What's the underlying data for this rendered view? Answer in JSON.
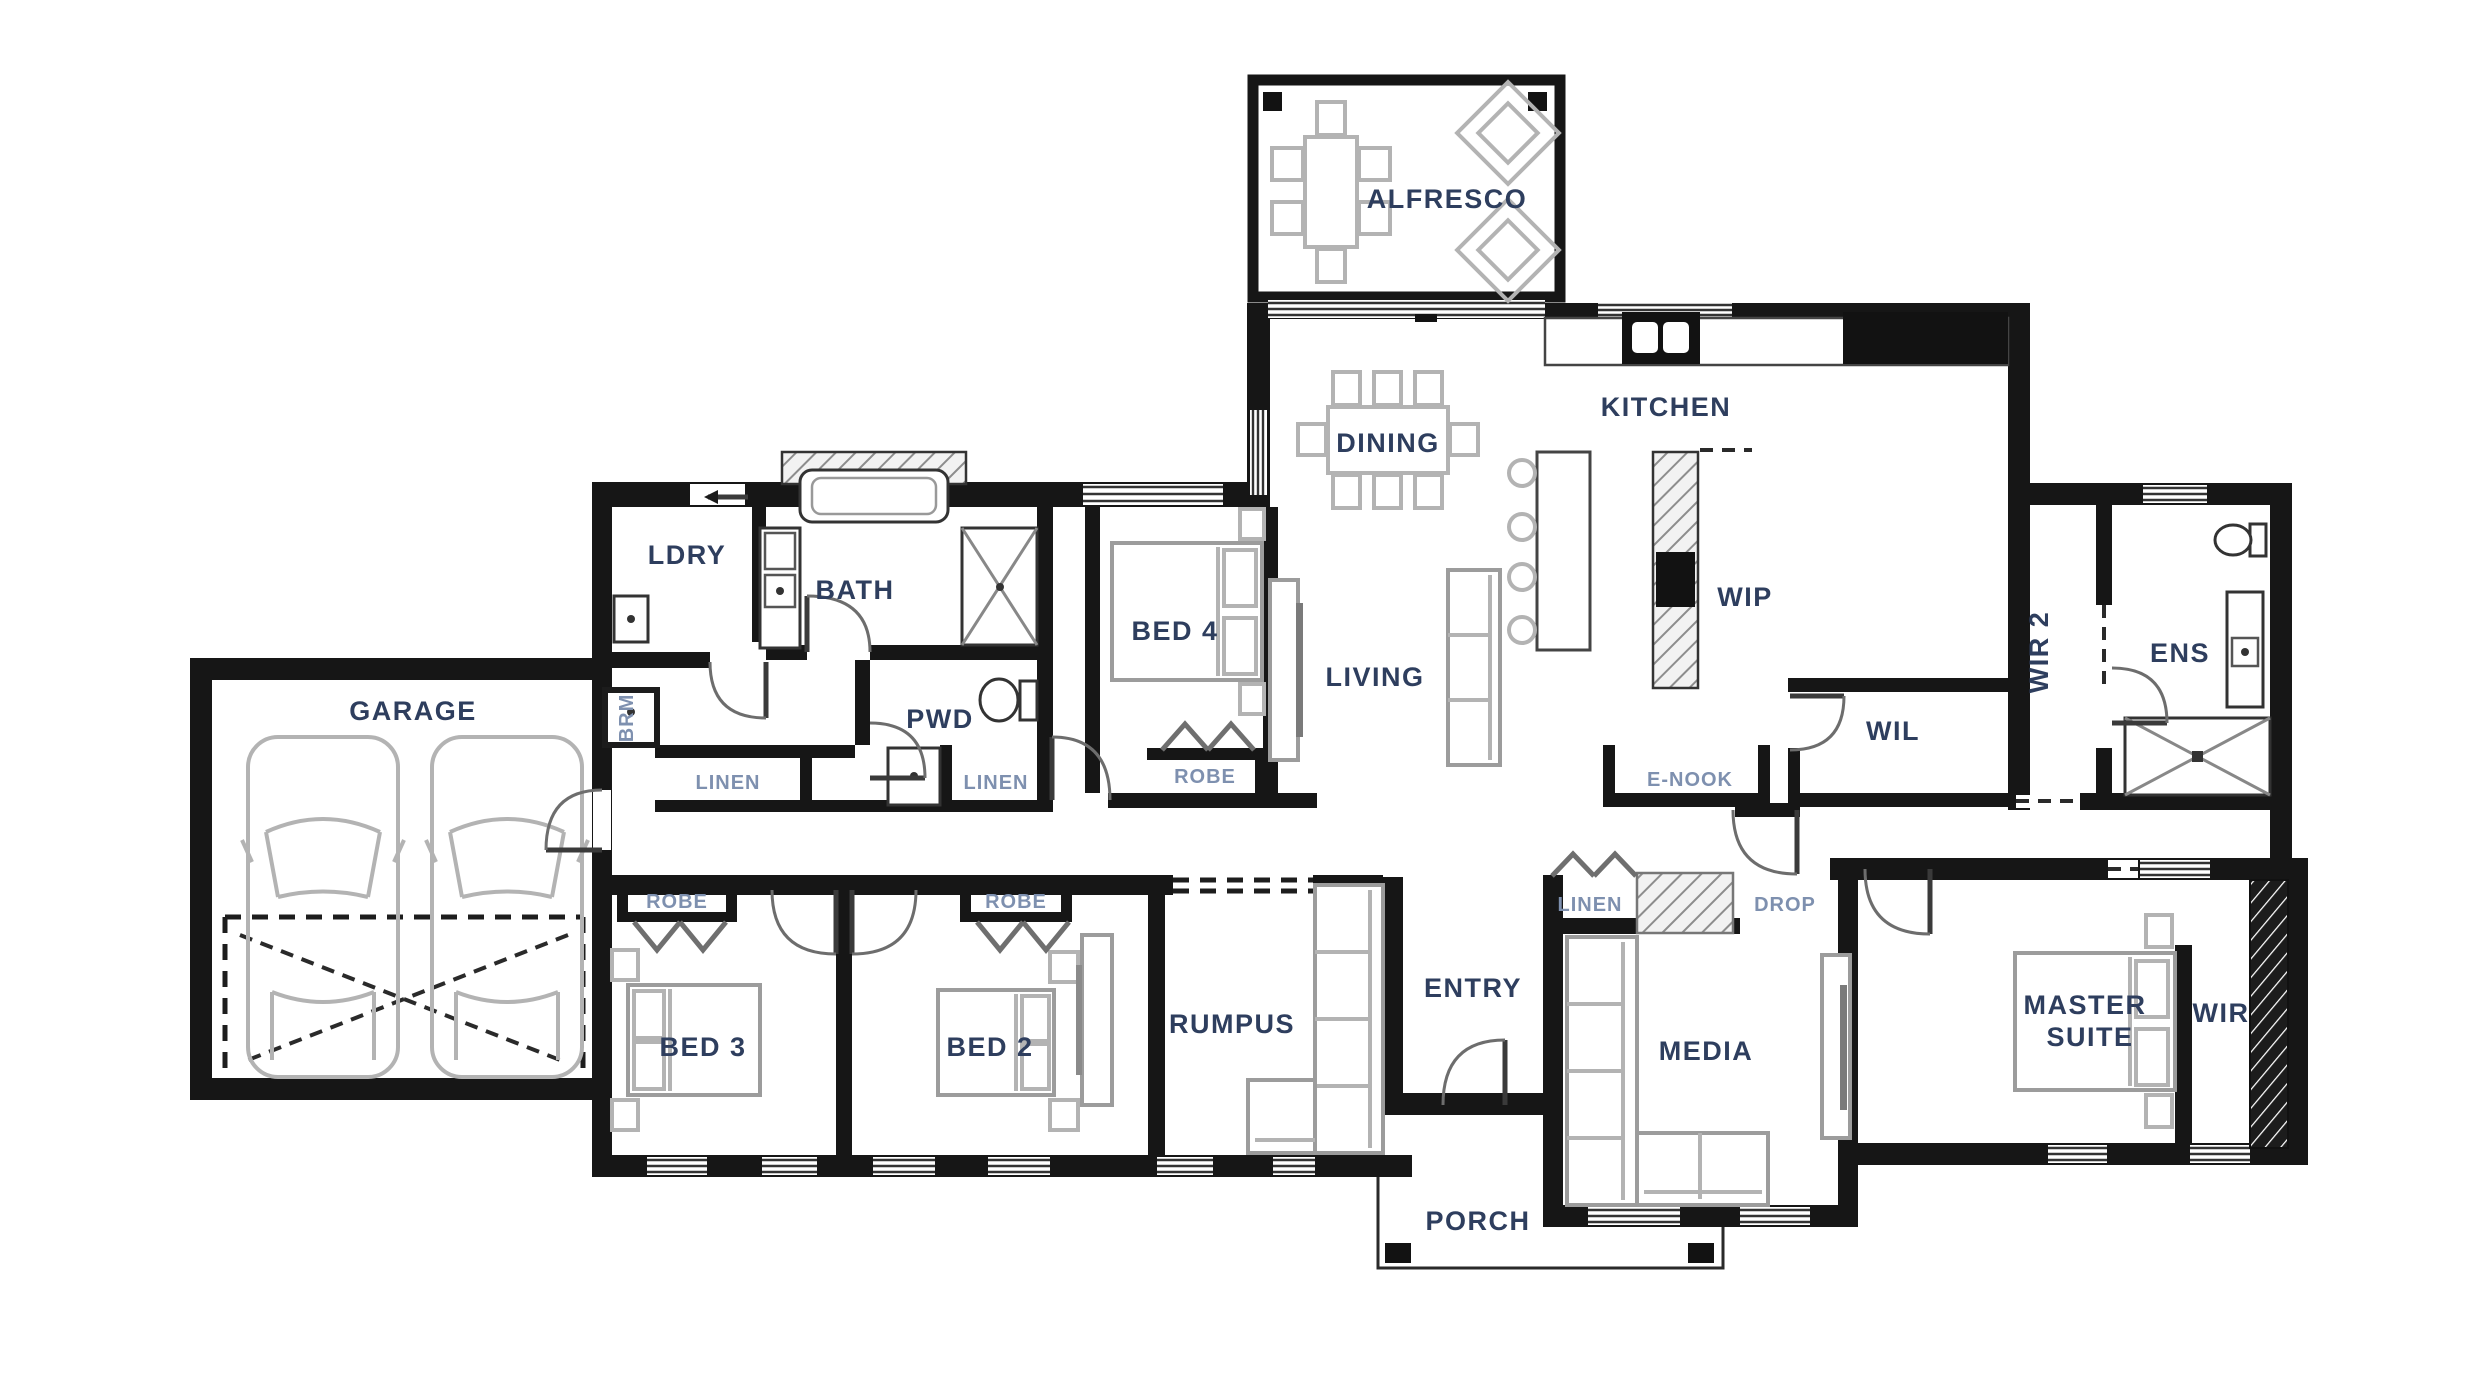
{
  "meta": {
    "drawing_type": "residential floor plan"
  },
  "colors": {
    "wall": "#161616",
    "label1": "#2e3e5e",
    "label2": "#7e90af",
    "furniture": "#9c9c9c"
  },
  "labels": {
    "alfresco": "ALFRESCO",
    "dining": "DINING",
    "kitchen": "KITCHEN",
    "wip": "WIP",
    "living": "LIVING",
    "wil": "WIL",
    "enook": "E-NOOK",
    "wir2": "WIR 2",
    "ens": "ENS",
    "bed4": "BED 4",
    "bath": "BATH",
    "ldry": "LDRY",
    "pwd": "PWD",
    "brm": "BRM",
    "linen1": "LINEN",
    "linen2": "LINEN",
    "linen3": "LINEN",
    "garage": "GARAGE",
    "robe3": "ROBE",
    "robe2": "ROBE",
    "robe4": "ROBE",
    "bed3": "BED 3",
    "bed2": "BED 2",
    "rumpus": "RUMPUS",
    "entry": "ENTRY",
    "media": "MEDIA",
    "drop": "DROP",
    "master1": "MASTER",
    "master2": "SUITE",
    "wir": "WIR",
    "porch": "PORCH"
  }
}
